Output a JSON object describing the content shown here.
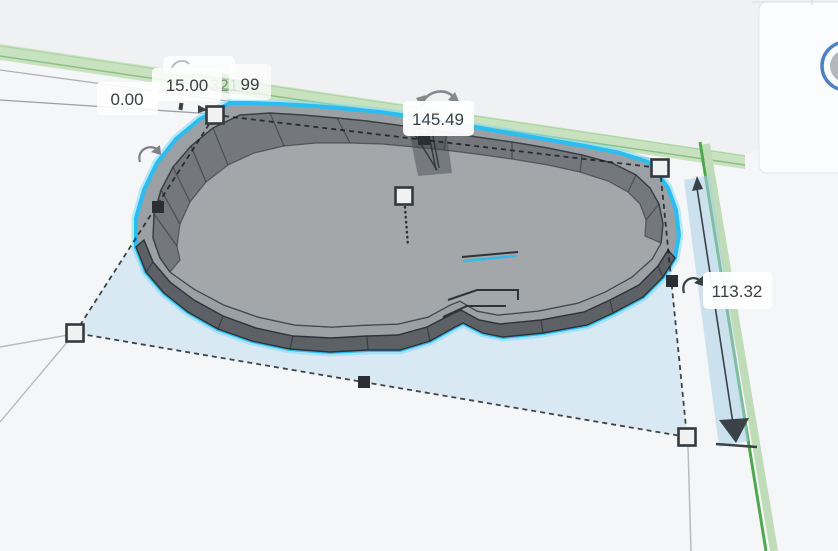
{
  "scene": {
    "type": "3d-modeling-viewport",
    "object": "pool-shaped solid (selected)"
  },
  "measurements": {
    "z_position": "0.00",
    "height": "15.00",
    "occluded_value": "321",
    "partial_value": "99",
    "length": "145.49",
    "width": "113.32"
  },
  "icons": {
    "rotate": "curved-double-arrow",
    "corner_handle": "white-square",
    "edge_handle": "black-square",
    "dimension_arrow": "filled-triangle-arrow"
  },
  "colors": {
    "selection_outline": "#29bdf2",
    "selection_plane_fill": "#cfe6f5",
    "workplane_edge_green": "#bfdcb8",
    "axis_green": "#4fa84f",
    "object_rim": "#9aa0a4",
    "object_wall": "#5d6165",
    "object_inner_wall": "#74787c",
    "object_floor": "#a4a7a9",
    "dimension_band": "#aacfe8",
    "label_text": "#3c4043",
    "panel_ring_blue": "#4d82c4"
  }
}
